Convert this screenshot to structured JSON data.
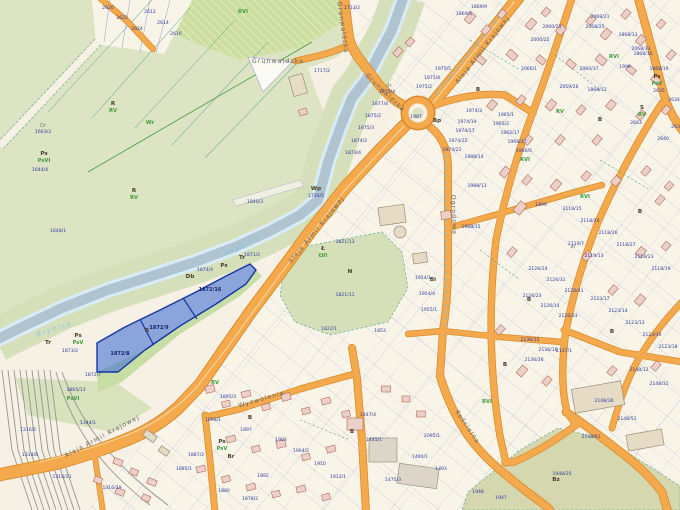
{
  "colors": {
    "background": "#f6f1e4",
    "farmland_green": "#dde4c3",
    "forest_green": "#cddfa0",
    "river_water": "#afc3d1",
    "river_edge": "#d8ecf6",
    "road_orange": "#f4a94c",
    "road_casing": "#d98a28",
    "building_pink": "#ecd0c8",
    "parcel_line_blue": "#8f9ace",
    "boundary_teal": "#49a08c",
    "selected_parcel_blue": "#3e6cd3",
    "selected_border": "#1736a4",
    "parcel_number_navy": "#2e3a9e",
    "landuse_green": "#3f9b3a",
    "park_olive": "#d5d7ae"
  },
  "river_labels": [
    {
      "t": "Brynica",
      "x": 243,
      "y": 247,
      "rot": -26
    },
    {
      "t": "Brynica",
      "x": 55,
      "y": 331,
      "rot": -18
    }
  ],
  "streets": [
    {
      "name": "Grunwaldzka",
      "x": 278,
      "y": 63,
      "rot": 0
    },
    {
      "name": "Grunwaldzka",
      "x": 341,
      "y": 28,
      "rot": 82
    },
    {
      "name": "Grunwaldzka",
      "x": 384,
      "y": 94,
      "rot": 44
    },
    {
      "name": "Aleja Armii Krajowej",
      "x": 484,
      "y": 51,
      "rot": -52
    },
    {
      "name": "Aleja Armii Krajowej",
      "x": 318,
      "y": 231,
      "rot": -51
    },
    {
      "name": "Aleja Armii Krajowej",
      "x": 103,
      "y": 438,
      "rot": -28
    },
    {
      "name": "Kościelna",
      "x": 466,
      "y": 428,
      "rot": 56
    },
    {
      "name": "Ogrodowa",
      "x": 452,
      "y": 215,
      "rot": 88
    },
    {
      "name": "Wyzwolenia",
      "x": 262,
      "y": 401,
      "rot": -16
    }
  ],
  "selected_parcels": {
    "numbers": [
      {
        "t": "1872/8",
        "x": 120,
        "y": 355
      },
      {
        "t": "1872/9",
        "x": 159,
        "y": 329
      },
      {
        "t": "1872/16",
        "x": 210,
        "y": 291
      }
    ]
  },
  "landuse_labels": [
    {
      "t": "R",
      "x": 113,
      "y": 105,
      "k": "l"
    },
    {
      "t": "RV",
      "x": 113,
      "y": 112,
      "k": "c"
    },
    {
      "t": "Ps",
      "x": 44,
      "y": 155,
      "k": "l"
    },
    {
      "t": "PsVI",
      "x": 44,
      "y": 162,
      "k": "c"
    },
    {
      "t": "R",
      "x": 134,
      "y": 192,
      "k": "l"
    },
    {
      "t": "RV",
      "x": 134,
      "y": 199,
      "k": "c"
    },
    {
      "t": "Wr",
      "x": 150,
      "y": 124,
      "k": "c"
    },
    {
      "t": "Dr",
      "x": 43,
      "y": 127,
      "k": "g"
    },
    {
      "t": "RVI",
      "x": 243,
      "y": 13,
      "k": "c"
    },
    {
      "t": "Wp",
      "x": 316,
      "y": 190,
      "k": "l"
    },
    {
      "t": "Ł",
      "x": 323,
      "y": 250,
      "k": "l"
    },
    {
      "t": "ŁVI",
      "x": 323,
      "y": 257,
      "k": "c"
    },
    {
      "t": "N",
      "x": 350,
      "y": 273,
      "k": "l"
    },
    {
      "t": "R",
      "x": 147,
      "y": 332,
      "k": "l"
    },
    {
      "t": "Tr",
      "x": 242,
      "y": 259,
      "k": "l"
    },
    {
      "t": "Ps",
      "x": 224,
      "y": 267,
      "k": "l"
    },
    {
      "t": "Db",
      "x": 190,
      "y": 278,
      "k": "l"
    },
    {
      "t": "Tr",
      "x": 48,
      "y": 344,
      "k": "l"
    },
    {
      "t": "Ps",
      "x": 78,
      "y": 337,
      "k": "l"
    },
    {
      "t": "PsV",
      "x": 78,
      "y": 344,
      "k": "c"
    },
    {
      "t": "PsVI",
      "x": 73,
      "y": 400,
      "k": "c"
    },
    {
      "t": "Bz",
      "x": 556,
      "y": 481,
      "k": "l"
    },
    {
      "t": "RVI",
      "x": 614,
      "y": 58,
      "k": "c"
    },
    {
      "t": "RVI",
      "x": 585,
      "y": 198,
      "k": "c"
    },
    {
      "t": "RV",
      "x": 560,
      "y": 113,
      "k": "c"
    },
    {
      "t": "RVI",
      "x": 525,
      "y": 161,
      "k": "c"
    },
    {
      "t": "RVI",
      "x": 487,
      "y": 403,
      "k": "c"
    },
    {
      "t": "RV",
      "x": 215,
      "y": 384,
      "k": "c"
    },
    {
      "t": "Ps",
      "x": 222,
      "y": 443,
      "k": "l"
    },
    {
      "t": "PsV",
      "x": 222,
      "y": 450,
      "k": "c"
    },
    {
      "t": "Br",
      "x": 231,
      "y": 458,
      "k": "l"
    },
    {
      "t": "B",
      "x": 478,
      "y": 91,
      "k": "l"
    },
    {
      "t": "B",
      "x": 529,
      "y": 301,
      "k": "l"
    },
    {
      "t": "B",
      "x": 612,
      "y": 333,
      "k": "l"
    },
    {
      "t": "B",
      "x": 250,
      "y": 419,
      "k": "l"
    },
    {
      "t": "B",
      "x": 352,
      "y": 433,
      "k": "l"
    },
    {
      "t": "B",
      "x": 640,
      "y": 213,
      "k": "l"
    },
    {
      "t": "B",
      "x": 600,
      "y": 121,
      "k": "l"
    },
    {
      "t": "B",
      "x": 505,
      "y": 366,
      "k": "l"
    },
    {
      "t": "Bp",
      "x": 437,
      "y": 122,
      "k": "l"
    },
    {
      "t": "Bi",
      "x": 433,
      "y": 281,
      "k": "l"
    },
    {
      "t": "Ps",
      "x": 657,
      "y": 78,
      "k": "l"
    },
    {
      "t": "PsV",
      "x": 657,
      "y": 85,
      "k": "c"
    },
    {
      "t": "S",
      "x": 642,
      "y": 109,
      "k": "l"
    },
    {
      "t": "RV",
      "x": 642,
      "y": 116,
      "k": "c"
    },
    {
      "t": "dr",
      "x": 389,
      "y": 87,
      "k": "g"
    },
    {
      "t": "dr",
      "x": 573,
      "y": 248,
      "k": "g"
    }
  ],
  "parcel_numbers": [
    {
      "t": "1644/4",
      "x": 40,
      "y": 171
    },
    {
      "t": "1648/1",
      "x": 58,
      "y": 232
    },
    {
      "t": "1663/3",
      "x": 43,
      "y": 133
    },
    {
      "t": "1840/3",
      "x": 255,
      "y": 203
    },
    {
      "t": "1736/5",
      "x": 316,
      "y": 197
    },
    {
      "t": "1871/2",
      "x": 252,
      "y": 256
    },
    {
      "t": "1874/4",
      "x": 205,
      "y": 271
    },
    {
      "t": "1865/13",
      "x": 76,
      "y": 391
    },
    {
      "t": "1872/7",
      "x": 93,
      "y": 376
    },
    {
      "t": "1873/2",
      "x": 70,
      "y": 352
    },
    {
      "t": "2620",
      "x": 108,
      "y": 9
    },
    {
      "t": "2622",
      "x": 122,
      "y": 19
    },
    {
      "t": "2624",
      "x": 137,
      "y": 30
    },
    {
      "t": "2612",
      "x": 150,
      "y": 13
    },
    {
      "t": "2614",
      "x": 163,
      "y": 24
    },
    {
      "t": "2616",
      "x": 176,
      "y": 35
    },
    {
      "t": "1713/2",
      "x": 352,
      "y": 9
    },
    {
      "t": "1717/2",
      "x": 322,
      "y": 72
    },
    {
      "t": "1875/4",
      "x": 387,
      "y": 93
    },
    {
      "t": "1877/4",
      "x": 380,
      "y": 105
    },
    {
      "t": "1875/2",
      "x": 373,
      "y": 117
    },
    {
      "t": "1875/3",
      "x": 366,
      "y": 129
    },
    {
      "t": "1874/2",
      "x": 359,
      "y": 142
    },
    {
      "t": "1873/4",
      "x": 353,
      "y": 154
    },
    {
      "t": "1975/4",
      "x": 432,
      "y": 79
    },
    {
      "t": "1975/5",
      "x": 443,
      "y": 70
    },
    {
      "t": "1975/2",
      "x": 424,
      "y": 88
    },
    {
      "t": "1987",
      "x": 416,
      "y": 118
    },
    {
      "t": "1974/3",
      "x": 474,
      "y": 112
    },
    {
      "t": "1974/19",
      "x": 467,
      "y": 123
    },
    {
      "t": "1974/17",
      "x": 465,
      "y": 132
    },
    {
      "t": "1974/22",
      "x": 458,
      "y": 142
    },
    {
      "t": "1974/21",
      "x": 452,
      "y": 151
    },
    {
      "t": "1988/14",
      "x": 474,
      "y": 158
    },
    {
      "t": "1988/13",
      "x": 477,
      "y": 187
    },
    {
      "t": "1988/15",
      "x": 471,
      "y": 228
    },
    {
      "t": "1965/1",
      "x": 506,
      "y": 116
    },
    {
      "t": "1965/2",
      "x": 501,
      "y": 125
    },
    {
      "t": "1965/17",
      "x": 510,
      "y": 134
    },
    {
      "t": "1966/27",
      "x": 517,
      "y": 143
    },
    {
      "t": "1966/5",
      "x": 524,
      "y": 152
    },
    {
      "t": "1869/5",
      "x": 464,
      "y": 15
    },
    {
      "t": "1869/9",
      "x": 479,
      "y": 8
    },
    {
      "t": "1868/13",
      "x": 628,
      "y": 36
    },
    {
      "t": "1868/15",
      "x": 643,
      "y": 55
    },
    {
      "t": "1868/12",
      "x": 597,
      "y": 91
    },
    {
      "t": "1868/19",
      "x": 659,
      "y": 70
    },
    {
      "t": "2068/21",
      "x": 600,
      "y": 18
    },
    {
      "t": "2068/25",
      "x": 595,
      "y": 28
    },
    {
      "t": "2068/33",
      "x": 641,
      "y": 50
    },
    {
      "t": "2060/37",
      "x": 589,
      "y": 70
    },
    {
      "t": "1999",
      "x": 625,
      "y": 68
    },
    {
      "t": "2000/21",
      "x": 552,
      "y": 28
    },
    {
      "t": "2000/25",
      "x": 540,
      "y": 41
    },
    {
      "t": "2059/26",
      "x": 569,
      "y": 88
    },
    {
      "t": "2066/1",
      "x": 529,
      "y": 70
    },
    {
      "t": "2634",
      "x": 674,
      "y": 101
    },
    {
      "t": "2635",
      "x": 659,
      "y": 92
    },
    {
      "t": "2640",
      "x": 663,
      "y": 140
    },
    {
      "t": "2643",
      "x": 636,
      "y": 124
    },
    {
      "t": "2637",
      "x": 677,
      "y": 128
    },
    {
      "t": "1899",
      "x": 541,
      "y": 206
    },
    {
      "t": "2118/15",
      "x": 572,
      "y": 210
    },
    {
      "t": "2118/24",
      "x": 590,
      "y": 222
    },
    {
      "t": "2118/26",
      "x": 608,
      "y": 234
    },
    {
      "t": "2118/27",
      "x": 626,
      "y": 246
    },
    {
      "t": "2118/23",
      "x": 644,
      "y": 258
    },
    {
      "t": "2118/19",
      "x": 661,
      "y": 270
    },
    {
      "t": "2119/7",
      "x": 576,
      "y": 245
    },
    {
      "t": "2119/13",
      "x": 594,
      "y": 257
    },
    {
      "t": "2126/24",
      "x": 538,
      "y": 270
    },
    {
      "t": "2126/31",
      "x": 556,
      "y": 281
    },
    {
      "t": "2126/41",
      "x": 574,
      "y": 292
    },
    {
      "t": "2126/23",
      "x": 532,
      "y": 297
    },
    {
      "t": "2126/14",
      "x": 550,
      "y": 307
    },
    {
      "t": "2126/33",
      "x": 568,
      "y": 317
    },
    {
      "t": "2123/17",
      "x": 600,
      "y": 300
    },
    {
      "t": "2123/14",
      "x": 618,
      "y": 312
    },
    {
      "t": "2123/13",
      "x": 635,
      "y": 324
    },
    {
      "t": "2123/16",
      "x": 652,
      "y": 336
    },
    {
      "t": "2123/18",
      "x": 668,
      "y": 348
    },
    {
      "t": "2136/15",
      "x": 530,
      "y": 341
    },
    {
      "t": "2136/16",
      "x": 548,
      "y": 351
    },
    {
      "t": "2136/26",
      "x": 534,
      "y": 361
    },
    {
      "t": "2137/1",
      "x": 564,
      "y": 352
    },
    {
      "t": "2148/12",
      "x": 639,
      "y": 371
    },
    {
      "t": "2148/31",
      "x": 659,
      "y": 385
    },
    {
      "t": "2148/36",
      "x": 604,
      "y": 402
    },
    {
      "t": "2148/51",
      "x": 627,
      "y": 420
    },
    {
      "t": "2148/61",
      "x": 591,
      "y": 438
    },
    {
      "t": "1821/13",
      "x": 345,
      "y": 243
    },
    {
      "t": "1821/11",
      "x": 345,
      "y": 296
    },
    {
      "t": "1822/1",
      "x": 329,
      "y": 330
    },
    {
      "t": "1853",
      "x": 380,
      "y": 332
    },
    {
      "t": "1954/1",
      "x": 423,
      "y": 279
    },
    {
      "t": "1954/4",
      "x": 427,
      "y": 295
    },
    {
      "t": "1955/1",
      "x": 429,
      "y": 311
    },
    {
      "t": "2095/1",
      "x": 432,
      "y": 437
    },
    {
      "t": "1490/1",
      "x": 420,
      "y": 458
    },
    {
      "t": "1475/3",
      "x": 393,
      "y": 481
    },
    {
      "t": "1447/4",
      "x": 368,
      "y": 416
    },
    {
      "t": "1445/1",
      "x": 374,
      "y": 441
    },
    {
      "t": "1493",
      "x": 441,
      "y": 470
    },
    {
      "t": "1948",
      "x": 478,
      "y": 493
    },
    {
      "t": "1947",
      "x": 501,
      "y": 499
    },
    {
      "t": "1948/25",
      "x": 562,
      "y": 475
    },
    {
      "t": "1316/2",
      "x": 28,
      "y": 431
    },
    {
      "t": "1344/1",
      "x": 88,
      "y": 424
    },
    {
      "t": "1316/21",
      "x": 62,
      "y": 478
    },
    {
      "t": "1316/19",
      "x": 112,
      "y": 489
    },
    {
      "t": "1314/6",
      "x": 30,
      "y": 456
    },
    {
      "t": "1895/3",
      "x": 228,
      "y": 398
    },
    {
      "t": "1898/1",
      "x": 213,
      "y": 421
    },
    {
      "t": "1897",
      "x": 246,
      "y": 431
    },
    {
      "t": "1892",
      "x": 263,
      "y": 477
    },
    {
      "t": "1887/2",
      "x": 196,
      "y": 456
    },
    {
      "t": "1885/1",
      "x": 184,
      "y": 470
    },
    {
      "t": "1903",
      "x": 281,
      "y": 441
    },
    {
      "t": "1904/2",
      "x": 301,
      "y": 452
    },
    {
      "t": "1910",
      "x": 320,
      "y": 465
    },
    {
      "t": "1912/1",
      "x": 338,
      "y": 478
    },
    {
      "t": "1880",
      "x": 224,
      "y": 492
    },
    {
      "t": "1878/2",
      "x": 250,
      "y": 500
    }
  ]
}
